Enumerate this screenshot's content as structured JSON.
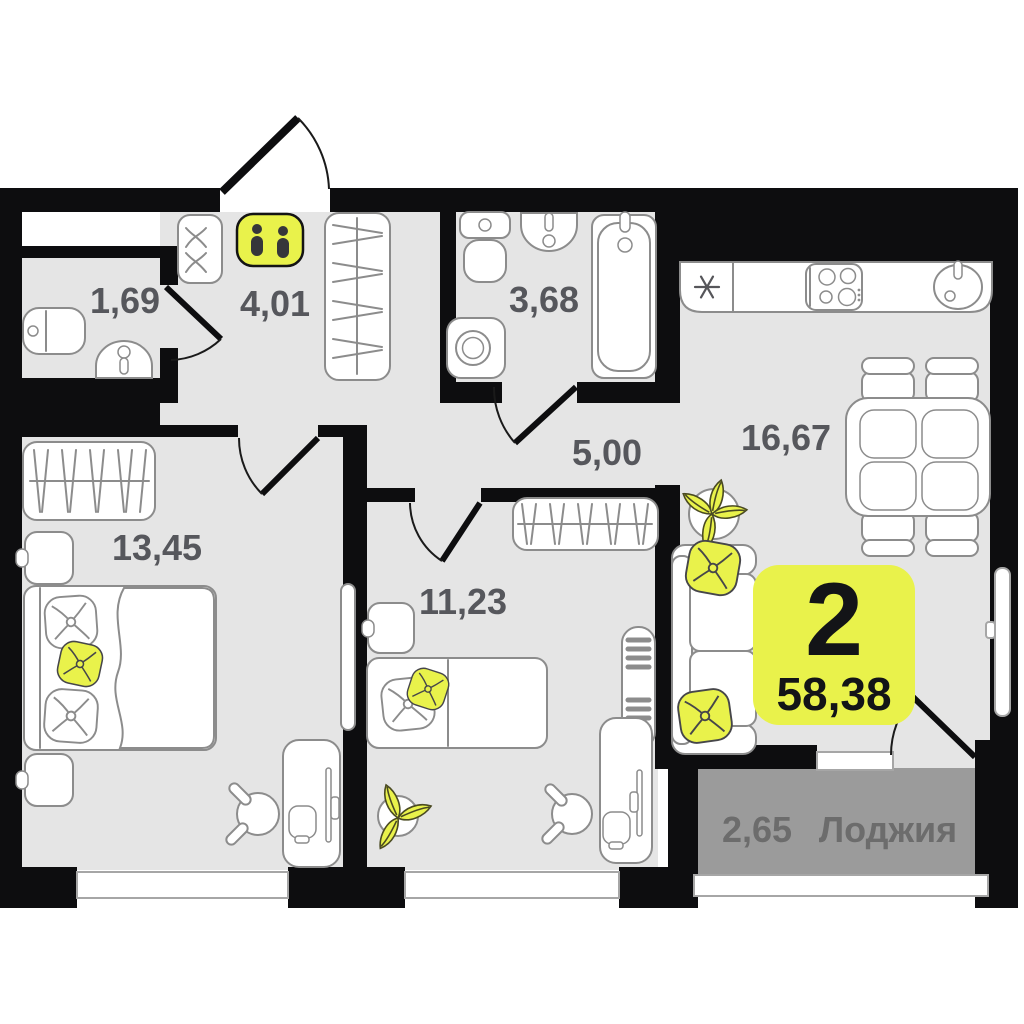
{
  "badge": {
    "rooms_count": "2",
    "total_area": "58,38"
  },
  "rooms": {
    "wc": {
      "area": "1,69"
    },
    "hallway": {
      "area": "4,01"
    },
    "bathroom": {
      "area": "3,68"
    },
    "corridor": {
      "area": "5,00"
    },
    "kitchen_living": {
      "area": "16,67"
    },
    "bedroom_1": {
      "area": "13,45"
    },
    "bedroom_2": {
      "area": "11,23"
    },
    "loggia": {
      "area": "2,65",
      "label": "Лоджия"
    }
  },
  "icons": {
    "footprints_icon": "👣",
    "snowflake_icon": "✳"
  },
  "colors": {
    "wall": "#0d0d0f",
    "room_fill": "#e5e5e5",
    "loggia_fill": "#9b9b9b",
    "accent_yellow": "#e9f24b",
    "furniture_outline": "#8c8c8c",
    "window_outline": "#a6a6a6",
    "label_text": "#56575c",
    "loggia_text": "#6c6c6c",
    "badge_text": "#131417",
    "icon_dark": "#36363a"
  }
}
